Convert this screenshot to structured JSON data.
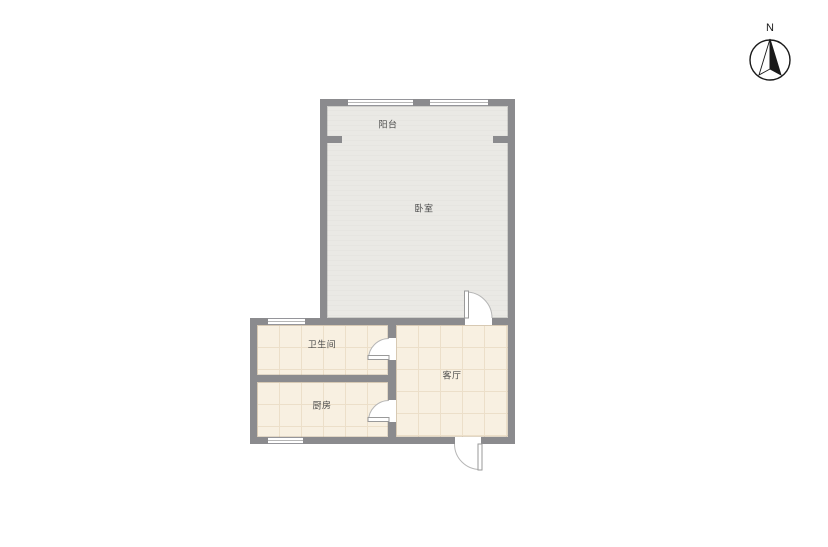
{
  "compass": {
    "label": "N"
  },
  "rooms": [
    {
      "id": "balcony",
      "label": "阳台"
    },
    {
      "id": "bedroom",
      "label": "卧室"
    },
    {
      "id": "bathroom",
      "label": "卫生间"
    },
    {
      "id": "kitchen",
      "label": "厨房"
    },
    {
      "id": "living-room",
      "label": "客厅"
    }
  ],
  "colors": {
    "wall": "#8b8b8e",
    "wall_edge": "#c6c6c8",
    "bedroom_floor": "#e6e5e1",
    "bedroom_floor_stripe": "#eae9e5",
    "tile_floor": "#f8f0e1",
    "tile_grid": "#ecdfc9",
    "window_frame": "#95959a",
    "window_glass": "#ffffff",
    "door_leaf_line": "#9a9a9a",
    "door_arc": "#b6b6b6",
    "label_text": "#4b4b4b",
    "compass_ink": "#1a1a1a",
    "background": "#ffffff"
  }
}
